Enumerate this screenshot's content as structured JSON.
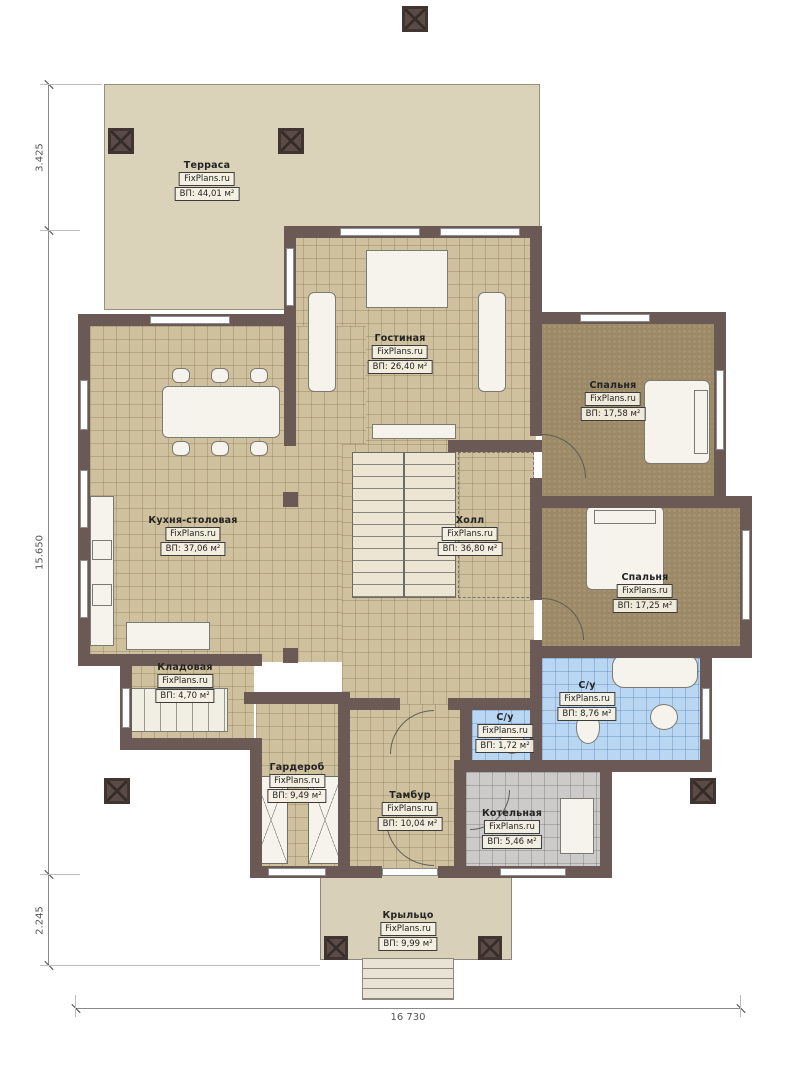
{
  "plan": {
    "watermark": "FixPlans.ru",
    "rooms": [
      {
        "id": "terrace",
        "name": "Терраса",
        "area": "ВП: 44,01 м²"
      },
      {
        "id": "living",
        "name": "Гостиная",
        "area": "ВП: 26,40 м²"
      },
      {
        "id": "bedroom1",
        "name": "Спальня",
        "area": "ВП: 17,58 м²"
      },
      {
        "id": "kitchen",
        "name": "Кухня-столовая",
        "area": "ВП: 37,06 м²"
      },
      {
        "id": "hall",
        "name": "Холл",
        "area": "ВП: 36,80 м²"
      },
      {
        "id": "bedroom2",
        "name": "Спальня",
        "area": "ВП: 17,25 м²"
      },
      {
        "id": "storage",
        "name": "Кладовая",
        "area": "ВП: 4,70 м²"
      },
      {
        "id": "bath1",
        "name": "С/у",
        "area": "ВП: 8,76 м²"
      },
      {
        "id": "bath2",
        "name": "С/у",
        "area": "ВП: 1,72 м²"
      },
      {
        "id": "wardrobe",
        "name": "Гардероб",
        "area": "ВП: 9,49 м²"
      },
      {
        "id": "vestibule",
        "name": "Тамбур",
        "area": "ВП: 10,04 м²"
      },
      {
        "id": "boiler",
        "name": "Котельная",
        "area": "ВП: 5,46 м²"
      },
      {
        "id": "porch",
        "name": "Крыльцо",
        "area": "ВП: 9,99 м²"
      }
    ],
    "dimensions": {
      "left_top": "3.425",
      "left_middle": "15.650",
      "left_bottom": "2.245",
      "bottom": "16 730"
    },
    "colors": {
      "wall": "#6b5955",
      "floor_tile": "#cfc09e",
      "terrace": "#dbd2ba",
      "bedroom_floor": "#9c8966",
      "bathroom_floor": "#b9d7f3",
      "boiler_floor": "#cccbc9"
    }
  }
}
